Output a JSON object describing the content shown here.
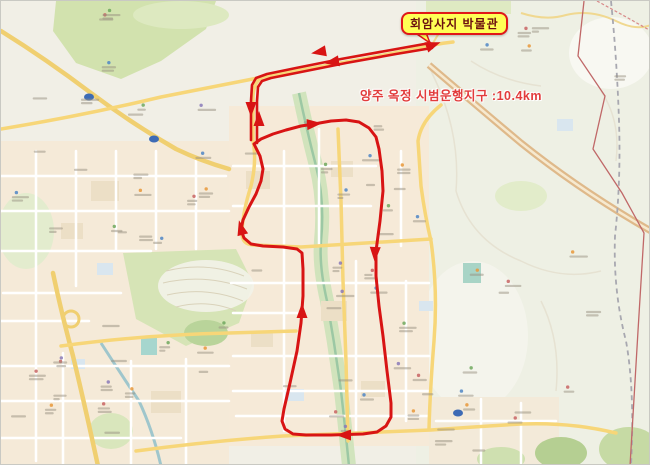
{
  "overlay": {
    "destination_label": "회암사지 박물관",
    "route_info": "양주 옥정 시범운행지구 :10.4km"
  },
  "colors": {
    "route": "#d81414",
    "label_bg": "#ffff55",
    "label_border": "#e01818",
    "label_text": "#6b0f0f",
    "info_text": "#e23c3c"
  },
  "route": {
    "distance_km": "10.4",
    "terminus": {
      "x": 429,
      "y": 44
    },
    "outbound_line": [
      [
        429,
        42
      ],
      [
        390,
        49
      ],
      [
        340,
        58
      ],
      [
        295,
        67
      ],
      [
        266,
        73
      ],
      [
        255,
        77
      ],
      [
        251,
        84
      ],
      [
        250,
        100
      ],
      [
        250,
        139
      ]
    ],
    "return_line": [
      [
        256,
        142
      ],
      [
        256,
        100
      ],
      [
        257,
        86
      ],
      [
        261,
        80
      ],
      [
        270,
        77
      ],
      [
        300,
        71
      ],
      [
        345,
        62
      ],
      [
        395,
        53
      ],
      [
        431,
        47
      ]
    ],
    "loop": [
      [
        253,
        143
      ],
      [
        260,
        138
      ],
      [
        272,
        133
      ],
      [
        285,
        129
      ],
      [
        300,
        125
      ],
      [
        313,
        123
      ],
      [
        330,
        120
      ],
      [
        345,
        119
      ],
      [
        358,
        121
      ],
      [
        368,
        127
      ],
      [
        375,
        136
      ],
      [
        378,
        148
      ],
      [
        381,
        170
      ],
      [
        382,
        190
      ],
      [
        379,
        220
      ],
      [
        375,
        250
      ],
      [
        375,
        275
      ],
      [
        378,
        305
      ],
      [
        382,
        335
      ],
      [
        386,
        370
      ],
      [
        390,
        402
      ],
      [
        390,
        416
      ],
      [
        385,
        425
      ],
      [
        376,
        431
      ],
      [
        362,
        433
      ],
      [
        330,
        434
      ],
      [
        305,
        434
      ],
      [
        292,
        433
      ],
      [
        284,
        428
      ],
      [
        281,
        420
      ],
      [
        283,
        408
      ],
      [
        289,
        382
      ],
      [
        296,
        350
      ],
      [
        300,
        322
      ],
      [
        302,
        295
      ],
      [
        302,
        268
      ],
      [
        301,
        252
      ],
      [
        296,
        248
      ],
      [
        282,
        246
      ],
      [
        262,
        245
      ],
      [
        250,
        243
      ],
      [
        243,
        237
      ],
      [
        240,
        229
      ],
      [
        242,
        219
      ],
      [
        248,
        206
      ],
      [
        255,
        193
      ],
      [
        260,
        180
      ],
      [
        262,
        168
      ],
      [
        259,
        155
      ],
      [
        253,
        143
      ]
    ],
    "arrows": [
      {
        "x": 318,
        "y": 51,
        "angle": 170
      },
      {
        "x": 331,
        "y": 61,
        "angle": 170
      },
      {
        "x": 250,
        "y": 108,
        "angle": 90
      },
      {
        "x": 258,
        "y": 118,
        "angle": 270
      },
      {
        "x": 313,
        "y": 123,
        "angle": -5
      },
      {
        "x": 374,
        "y": 253,
        "angle": 92
      },
      {
        "x": 343,
        "y": 434,
        "angle": 180
      },
      {
        "x": 301,
        "y": 310,
        "angle": 270
      },
      {
        "x": 240,
        "y": 227,
        "angle": 255
      },
      {
        "x": 432,
        "y": 44,
        "angle": 340
      }
    ]
  }
}
